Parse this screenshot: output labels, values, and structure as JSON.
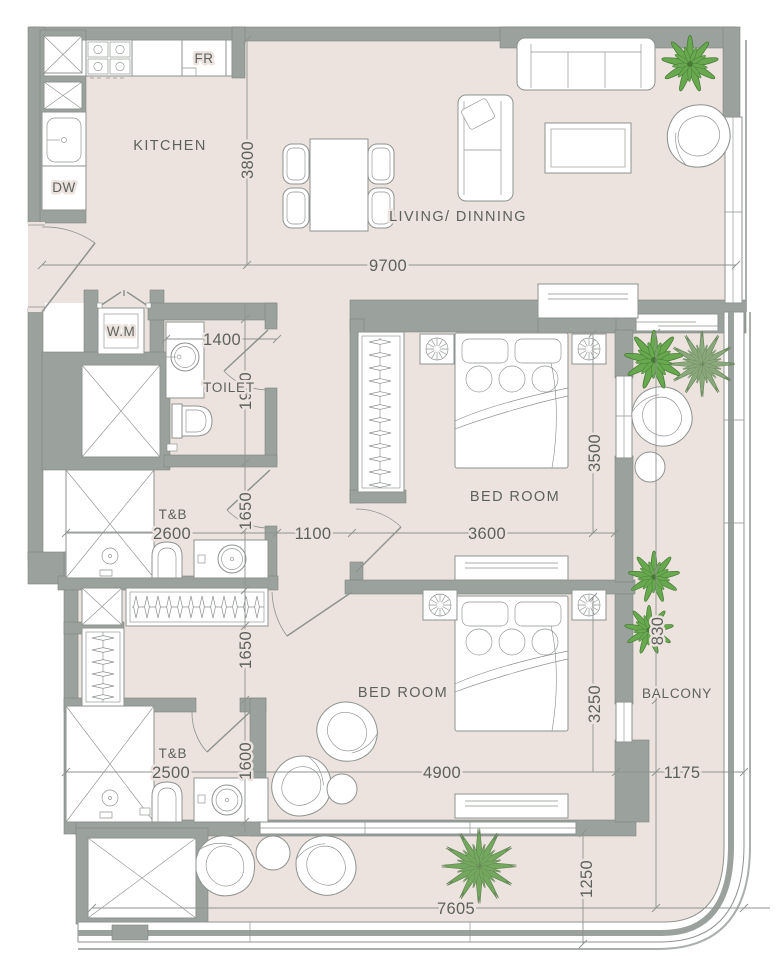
{
  "plan": {
    "rooms": {
      "kitchen": "KITCHEN",
      "living_dining": "LIVING/ DINNING",
      "toilet": "TOILET",
      "bedroom1": "BED ROOM",
      "bedroom2": "BED ROOM",
      "balcony": "BALCONY",
      "tb1": "T&B",
      "tb2": "T&B"
    },
    "appliances": {
      "washing_machine": "W.M",
      "fridge": "FR",
      "dishwasher": "DW"
    },
    "dimensions": {
      "kitchen_depth": "3800",
      "living_width": "9700",
      "toilet_width": "1400",
      "toilet_depth": "1900",
      "tb1_width": "2600",
      "tb1_door": "1650",
      "hall_width": "1100",
      "bedroom1_width": "3600",
      "bedroom1_depth": "3500",
      "wardrobe_depth": "1650",
      "tb2_width": "2500",
      "tb2_door": "1600",
      "bedroom2_width": "4900",
      "bedroom2_depth": "3250",
      "balcony_upper": "830",
      "balcony_width": "1175",
      "balcony_bottom_depth": "1250",
      "balcony_bottom_width": "7605"
    },
    "colors": {
      "wall": "#9ba19c",
      "wallEdge": "#7f857f",
      "floor": "#ece3de",
      "line": "#8e938f",
      "text": "#5d615d",
      "leaf": "#68a94f",
      "leafDark": "#457a35",
      "palm": "#8aa87b",
      "palmDark": "#5f7f53"
    }
  }
}
